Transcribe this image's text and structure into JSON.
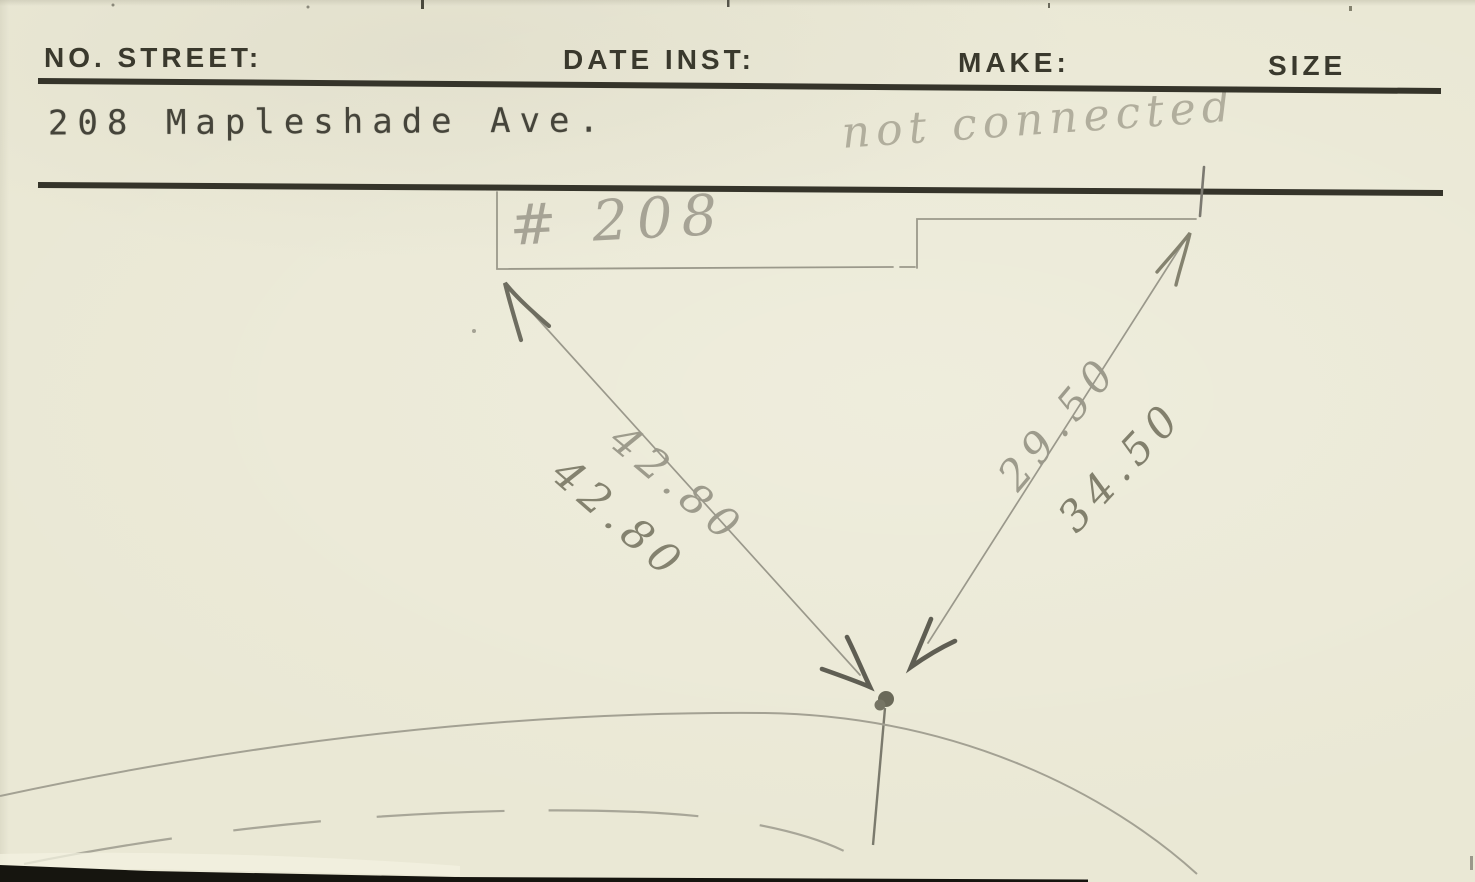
{
  "card": {
    "type_style": "typed index card, scanned",
    "colors": {
      "paper": "#eae8d5",
      "ink": "#3a392d",
      "typewriter_ink": "#45443a",
      "pencil_light": "#a4a294",
      "pencil_dark": "#5f5e53"
    }
  },
  "header": {
    "fields": [
      {
        "label": "NO. STREET:"
      },
      {
        "label": "DATE INST:"
      },
      {
        "label": "MAKE:"
      },
      {
        "label": "SIZE"
      }
    ]
  },
  "record": {
    "address": "208 Mapleshade Ave."
  },
  "handwriting": {
    "status_note": "not connected",
    "house_label": "# 208",
    "measurements": {
      "left_upper": "42.80",
      "left_lower": "42.80",
      "right_upper": "29.50",
      "right_lower": "34.50"
    }
  }
}
